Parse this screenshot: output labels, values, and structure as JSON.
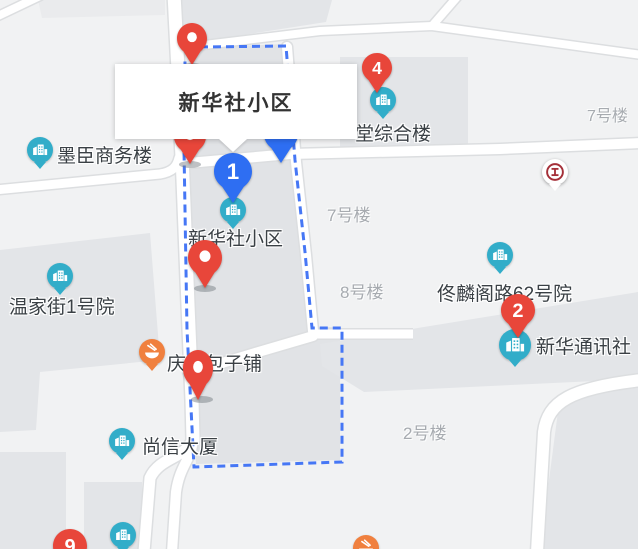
{
  "map": {
    "info_box": {
      "title": "新华社小区"
    },
    "colors": {
      "pin_red": "#e8463a",
      "pin_blue": "#2e6ef2",
      "poi_teal": "#32adc9",
      "poi_orange": "#f0803e",
      "bank_red": "#a42f38",
      "boundary_blue": "#4677f5",
      "label_dark": "#3a4045",
      "label_gray": "#a7abb0"
    },
    "labels": [
      {
        "name": "label-mochen-office",
        "text": "墨臣商务楼",
        "x": 57,
        "y": 141,
        "size": 19,
        "variant": "dark",
        "clickable": true
      },
      {
        "name": "label-wenjiajie-1",
        "text": "温家街1号院",
        "x": 9,
        "y": 292,
        "size": 19,
        "variant": "dark",
        "clickable": true
      },
      {
        "name": "label-xinhuashe-xiaoqu",
        "text": "新华社小区",
        "x": 188,
        "y": 224,
        "size": 19,
        "variant": "dark",
        "clickable": true
      },
      {
        "name": "label-canteen-complex",
        "text": "堂综合楼",
        "x": 355,
        "y": 119,
        "size": 19,
        "variant": "dark",
        "clickable": true
      },
      {
        "name": "label-tonglinge-62",
        "text": "佟麟阁路62号院",
        "x": 437,
        "y": 279,
        "size": 19,
        "variant": "dark",
        "clickable": true
      },
      {
        "name": "label-xinhua-news",
        "text": "新华通讯社",
        "x": 536,
        "y": 332,
        "size": 19,
        "variant": "dark",
        "clickable": true
      },
      {
        "name": "label-shangxin-tower",
        "text": "尚信大厦",
        "x": 142,
        "y": 432,
        "size": 19,
        "variant": "dark",
        "clickable": true
      },
      {
        "name": "label-qingfeng-baozi",
        "text": "庆丰包子铺",
        "x": 167,
        "y": 349,
        "size": 19,
        "variant": "dark",
        "clickable": true
      },
      {
        "name": "label-building-7-ne",
        "text": "7号楼",
        "x": 587,
        "y": 102,
        "size": 16,
        "variant": "gray",
        "clickable": false
      },
      {
        "name": "label-building-7-mid",
        "text": "7号楼",
        "x": 327,
        "y": 201,
        "size": 17,
        "variant": "gray",
        "clickable": false
      },
      {
        "name": "label-building-8",
        "text": "8号楼",
        "x": 340,
        "y": 278,
        "size": 17,
        "variant": "gray",
        "clickable": false
      },
      {
        "name": "label-building-2",
        "text": "2号楼",
        "x": 403,
        "y": 419,
        "size": 17,
        "variant": "gray",
        "clickable": false
      }
    ],
    "poi_markers": [
      {
        "name": "poi-mochen-office",
        "type": "building",
        "x": 40,
        "y": 150,
        "r": 13
      },
      {
        "name": "poi-wenjiajie-1",
        "type": "building",
        "x": 60,
        "y": 276,
        "r": 13
      },
      {
        "name": "poi-xinhuashe-xiaoqu",
        "type": "building",
        "x": 233,
        "y": 210,
        "r": 13
      },
      {
        "name": "poi-canteen-complex",
        "type": "building",
        "x": 383,
        "y": 100,
        "r": 13
      },
      {
        "name": "poi-tonglinge-62",
        "type": "building",
        "x": 500,
        "y": 255,
        "r": 13
      },
      {
        "name": "poi-xinhua-news",
        "type": "building",
        "x": 515,
        "y": 345,
        "r": 16
      },
      {
        "name": "poi-shangxin-tower",
        "type": "building",
        "x": 122,
        "y": 441,
        "r": 13
      },
      {
        "name": "poi-building-bottom",
        "type": "building",
        "x": 123,
        "y": 535,
        "r": 13
      },
      {
        "name": "poi-qingfeng-baozi",
        "type": "food",
        "x": 152,
        "y": 352,
        "r": 13
      },
      {
        "name": "poi-food-bottom",
        "type": "food",
        "x": 366,
        "y": 548,
        "r": 13
      },
      {
        "name": "poi-icbc-bank",
        "type": "bank",
        "x": 555,
        "y": 172,
        "r": 13
      }
    ],
    "pins": [
      {
        "name": "pin-plain-top",
        "kind": "red-plain",
        "number": "",
        "x": 192,
        "y": 65,
        "w": 30,
        "h": 42,
        "z": 20
      },
      {
        "name": "pin-plain-under-popup",
        "kind": "red-plain",
        "number": "",
        "x": 190,
        "y": 164,
        "w": 32,
        "h": 44,
        "z": 20
      },
      {
        "name": "pin-blue-partial",
        "kind": "blue-plain",
        "number": "",
        "x": 281,
        "y": 163,
        "w": 34,
        "h": 46,
        "z": 18
      },
      {
        "name": "pin-plain-mid",
        "kind": "red-plain",
        "number": "",
        "x": 205,
        "y": 288,
        "w": 34,
        "h": 48,
        "z": 20
      },
      {
        "name": "pin-plain-baozi",
        "kind": "red-plain",
        "number": "",
        "x": 198,
        "y": 400,
        "w": 30,
        "h": 50,
        "z": 20
      },
      {
        "name": "pin-number-1",
        "kind": "blue-num",
        "number": "1",
        "x": 233,
        "y": 203,
        "w": 38,
        "h": 50,
        "z": 22
      },
      {
        "name": "pin-number-4",
        "kind": "red-num",
        "number": "4",
        "x": 377,
        "y": 93,
        "w": 30,
        "h": 40,
        "z": 22
      },
      {
        "name": "pin-number-2",
        "kind": "red-num",
        "number": "2",
        "x": 518,
        "y": 338,
        "w": 34,
        "h": 44,
        "z": 22
      },
      {
        "name": "pin-number-9",
        "kind": "red-num",
        "number": "9",
        "x": 70,
        "y": 575,
        "w": 34,
        "h": 46,
        "z": 22
      }
    ],
    "pin_shadows": [
      {
        "x": 192,
        "y": 66
      },
      {
        "x": 190,
        "y": 164
      },
      {
        "x": 205,
        "y": 288
      },
      {
        "x": 202,
        "y": 399
      }
    ]
  }
}
